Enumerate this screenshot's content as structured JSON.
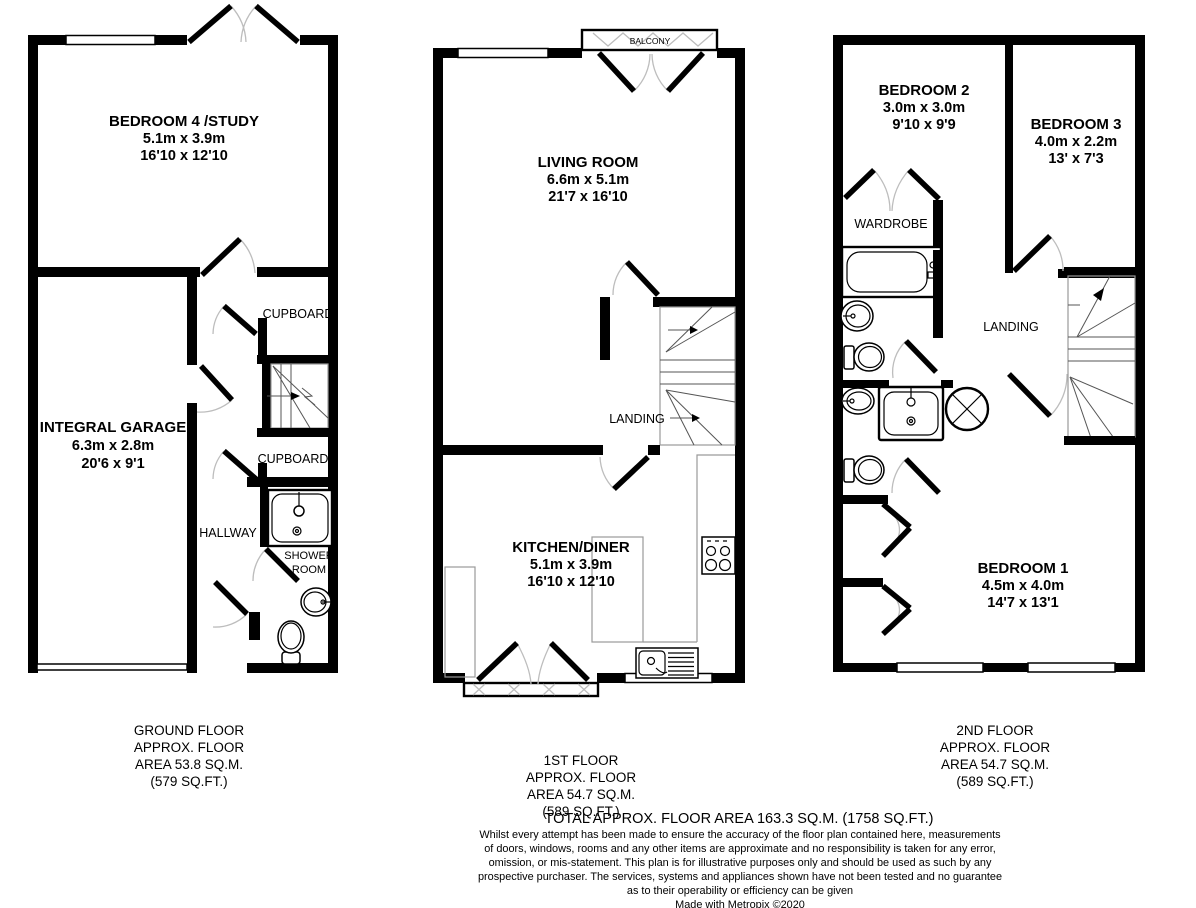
{
  "plans": {
    "ground": {
      "bedroom4": {
        "name": "BEDROOM 4 /STUDY",
        "metric": "5.1m x 3.9m",
        "imperial": "16'10 x 12'10"
      },
      "garage": {
        "name": "INTEGRAL GARAGE",
        "metric": "6.3m x 2.8m",
        "imperial": "20'6 x 9'1"
      },
      "cupboard_upper": "CUPBOARD",
      "cupboard_lower": "CUPBOARD",
      "hallway": "HALLWAY",
      "shower_room": {
        "line1": "SHOWER",
        "line2": "ROOM"
      },
      "footer": {
        "line1": "GROUND FLOOR",
        "line2": "APPROX. FLOOR",
        "line3": "AREA 53.8 SQ.M.",
        "line4": "(579 SQ.FT.)"
      }
    },
    "first": {
      "living": {
        "name": "LIVING ROOM",
        "metric": "6.6m x 5.1m",
        "imperial": "21'7 x 16'10"
      },
      "kitchen": {
        "name": "KITCHEN/DINER",
        "metric": "5.1m x 3.9m",
        "imperial": "16'10 x 12'10"
      },
      "landing": "LANDING",
      "balcony": "BALCONY",
      "footer": {
        "line1": "1ST FLOOR",
        "line2": "APPROX. FLOOR",
        "line3": "AREA 54.7 SQ.M.",
        "line4": "(589 SQ.FT.)"
      }
    },
    "second": {
      "bedroom1": {
        "name": "BEDROOM 1",
        "metric": "4.5m x 4.0m",
        "imperial": "14'7 x 13'1"
      },
      "bedroom2": {
        "name": "BEDROOM 2",
        "metric": "3.0m x 3.0m",
        "imperial": "9'10 x 9'9"
      },
      "bedroom3": {
        "name": "BEDROOM 3",
        "metric": "4.0m x 2.2m",
        "imperial": "13' x 7'3"
      },
      "wardrobe": "WARDROBE",
      "landing": "LANDING",
      "footer": {
        "line1": "2ND FLOOR",
        "line2": "APPROX. FLOOR",
        "line3": "AREA 54.7 SQ.M.",
        "line4": "(589 SQ.FT.)"
      }
    }
  },
  "total": "TOTAL APPROX. FLOOR AREA 163.3 SQ.M. (1758 SQ.FT.)",
  "disclaimer": {
    "line1": "Whilst every attempt has been made to ensure the accuracy of the floor plan contained here, measurements",
    "line2": "of doors, windows, rooms and any other items are approximate and no responsibility is taken for any error,",
    "line3": "omission, or mis-statement. This plan is for illustrative purposes only and should be used as such by any",
    "line4": "prospective purchaser. The services, systems and appliances shown have not been tested and no guarantee",
    "line5": "as to their operability or efficiency can be given",
    "credit": "Made with Metropix ©2020"
  }
}
